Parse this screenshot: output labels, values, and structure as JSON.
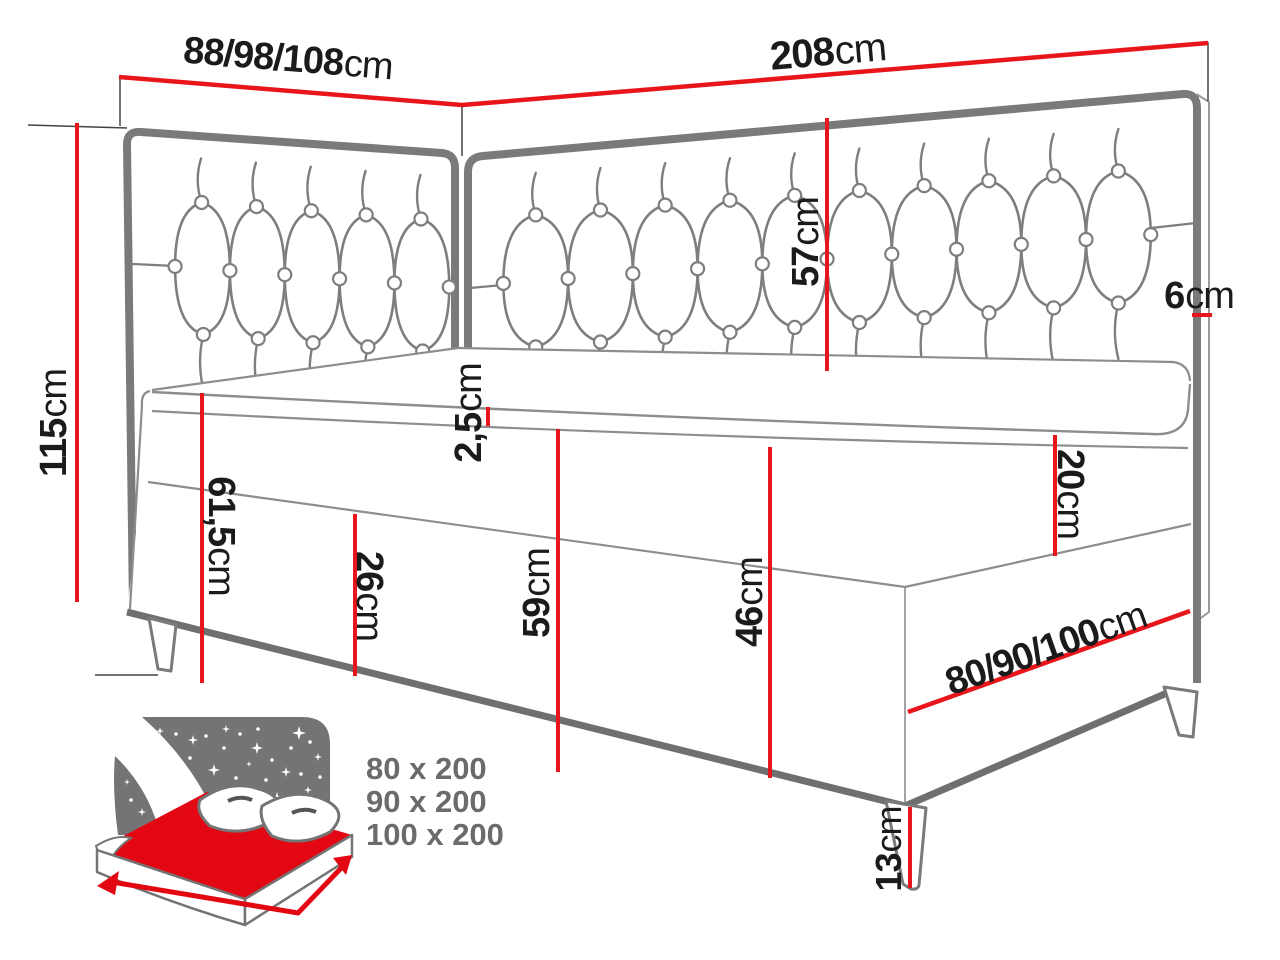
{
  "diagram_title": "Corner boxspring bed dimensions",
  "dims": {
    "headboard_width": {
      "value": "88/98/108",
      "unit": "cm"
    },
    "length": {
      "value": "208",
      "unit": "cm"
    },
    "height": {
      "value": "115",
      "unit": "cm"
    },
    "headboard_panel_height": {
      "value": "57",
      "unit": "cm"
    },
    "headboard_thickness": {
      "value": "6",
      "unit": "cm"
    },
    "topper": {
      "value": "2,5",
      "unit": "cm"
    },
    "head_side_height": {
      "value": "61,5",
      "unit": "cm"
    },
    "lower_box_height": {
      "value": "26",
      "unit": "cm"
    },
    "mid_side_height": {
      "value": "59",
      "unit": "cm"
    },
    "foot_side_height": {
      "value": "46",
      "unit": "cm"
    },
    "mattress_height": {
      "value": "20",
      "unit": "cm"
    },
    "width": {
      "value": "80/90/100",
      "unit": "cm"
    },
    "leg_height": {
      "value": "13",
      "unit": "cm"
    }
  },
  "sizes": {
    "items": [
      "80 x 200",
      "90 x 200",
      "100 x 200"
    ]
  },
  "colors": {
    "dimension_red": "#e8151b",
    "outline_gray": "#7a7a7a",
    "text_black": "#1b1b1b",
    "sizes_gray": "#6b6b6b",
    "icon_gray": "#747474",
    "icon_red": "#e30613"
  }
}
